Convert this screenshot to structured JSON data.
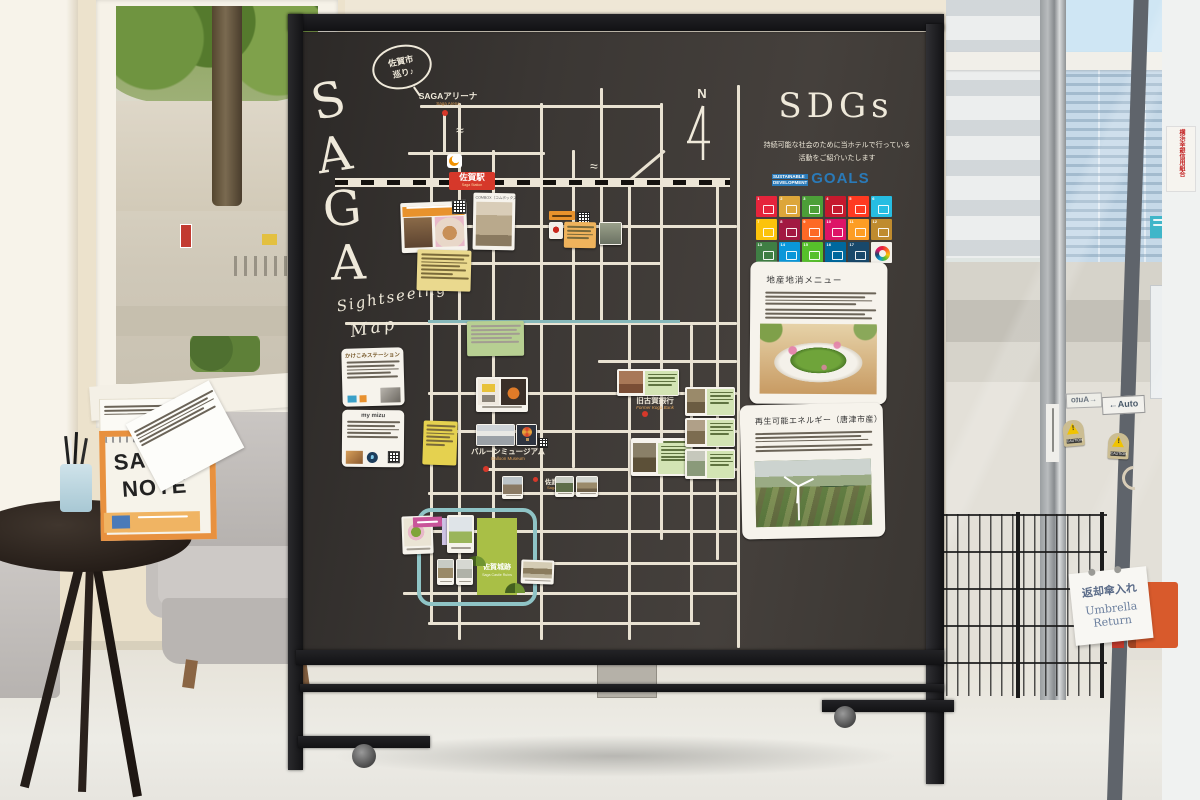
{
  "board": {
    "letters": [
      "S",
      "A",
      "G",
      "A"
    ],
    "bubble_line1": "佐賀市",
    "bubble_line2": "巡り♪",
    "script_line1": "Sightseeing",
    "script_line2": "Map",
    "north": "N",
    "wave": "≈",
    "map": {
      "arena": {
        "jp": "SAGAアリーナ",
        "en": "Saga Arena"
      },
      "station": {
        "jp": "佐賀駅",
        "en": "Saga Station"
      },
      "balloon": {
        "jp": "バルーンミュージアム",
        "en": "Balloon Museum"
      },
      "shrine": {
        "jp": "佐嘉神社",
        "en": "Saga Shrine"
      },
      "bank": {
        "jp": "旧古賀銀行",
        "en": "Former Koga Bank"
      },
      "castle": {
        "jp": "佐賀城跡",
        "en": "Saga Castle Ruins"
      },
      "combox": "COMBOX（コムボックス）",
      "kakekomi_title": "かけこみステーション",
      "mymizu_title": "my mizu"
    },
    "sdgs": {
      "title": "SDGs",
      "caption_line1": "持続可能な社会のために当ホテルで行っている",
      "caption_line2": "活動をご紹介いたします",
      "logo_word1": "SUSTAINABLE",
      "logo_word2": "DEVELOPMENT",
      "logo_goals": "GOALS",
      "tile_colors": [
        "#e5243b",
        "#dda63a",
        "#4c9f38",
        "#c5192d",
        "#ff3a21",
        "#26bde2",
        "#fcc30b",
        "#a21942",
        "#fd6925",
        "#dd1367",
        "#fd9d24",
        "#bf8b2e",
        "#3f7e44",
        "#0a97d9",
        "#56c02b",
        "#00689d",
        "#19486a"
      ],
      "card1_title": "地産地消メニュー",
      "card2_title": "再生可能エネルギー（唐津市産）"
    },
    "accent_colors": {
      "marker_red": "#d6382a",
      "river_teal": "#8fc4c6",
      "castle_green": "#a9bf46"
    }
  },
  "room": {
    "note_stand": {
      "title_line1": "SAGA",
      "title_line2": "NOTE"
    },
    "door": {
      "auto": "←Auto",
      "caution": "CAUTION",
      "exclaim": "!"
    },
    "umbrella_sign": {
      "jp": "返却傘入れ",
      "en_line1": "Umbrella",
      "en_line2": "Return"
    },
    "outside_sign_text": "横浜幸銀信用組合"
  }
}
